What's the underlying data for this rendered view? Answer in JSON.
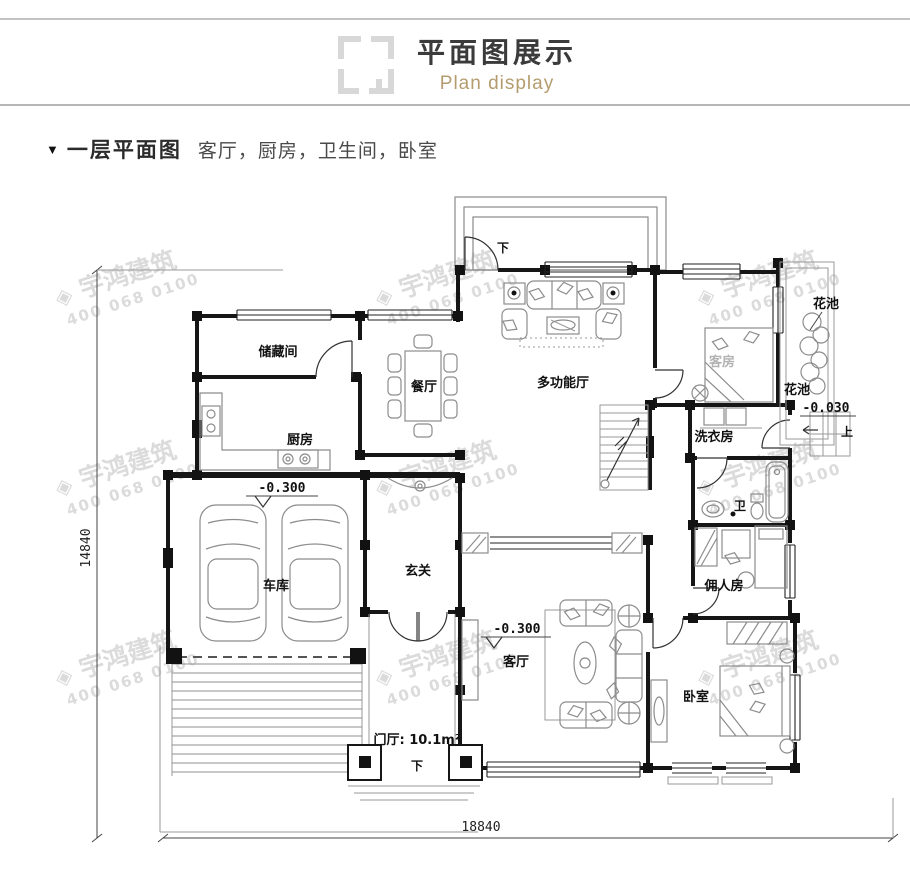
{
  "header": {
    "title": "平面图展示",
    "subtitle": "Plan display"
  },
  "section": {
    "marker": "▼",
    "title": "一层平面图",
    "description": "客厅，厨房，卫生间，卧室"
  },
  "watermark": {
    "logo": "◈",
    "name": "宇鸿建筑",
    "phone": "400 068 0100"
  },
  "plan": {
    "rooms": {
      "storage": "储藏间",
      "dining": "餐厅",
      "multi_hall": "多功能厅",
      "kitchen": "厨房",
      "guest_room": "客房",
      "flower_bed": "花池",
      "laundry": "洗衣房",
      "garage": "车库",
      "foyer": "玄关",
      "bath": "卫",
      "servant_room": "佣人房",
      "living_room": "客厅",
      "bedroom": "卧室",
      "entry_hall": "门厅: 10.1m²"
    },
    "annotations": {
      "down": "下",
      "up": "上",
      "elev_300": "-0.300",
      "elev_030": "-0.030"
    },
    "dimensions": {
      "left": "14840",
      "bottom": "18840"
    }
  },
  "colors": {
    "accent_gold": "#b49c6e",
    "line_dark": "#161616",
    "divider_gray": "#b5b5b5",
    "watermark": "#dbdbdb"
  }
}
